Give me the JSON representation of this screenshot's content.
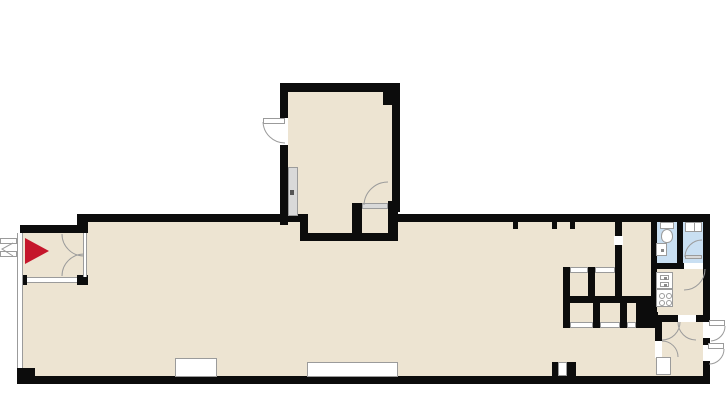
{
  "palette": {
    "background": "#ffffff",
    "floor": "#ede4d2",
    "wall": "#0c0c0c",
    "bath_floor": "#c9dff2",
    "accent_red": "#c5162b",
    "line_gray": "#9b9b9b",
    "panel_gray": "#d9d9d9"
  },
  "plan": {
    "type": "architectural-floor-plan",
    "text_labels": [],
    "features": [
      "entry-vestibule with double swing doors and red entrance arrow",
      "large open main hall with glazed left wall",
      "upper annex room with exterior swing door, sliding door panel and door closet alcove",
      "stall / stair block of small cells with door gaps",
      "kitchenette with two-basin sink unit and four-burner stove",
      "two bathroom cells with toilet, wash basin and shower tray",
      "rear vestibule with two exterior exit doors and service niche",
      "window niches along bottom exterior wall"
    ],
    "icons": [
      "entrance-arrow-icon",
      "toilet-icon",
      "basin-icon",
      "shower-tray-icon",
      "stove-icon",
      "kitchen-sink-icon",
      "door-swing-arc",
      "sliding-door-panel"
    ]
  }
}
